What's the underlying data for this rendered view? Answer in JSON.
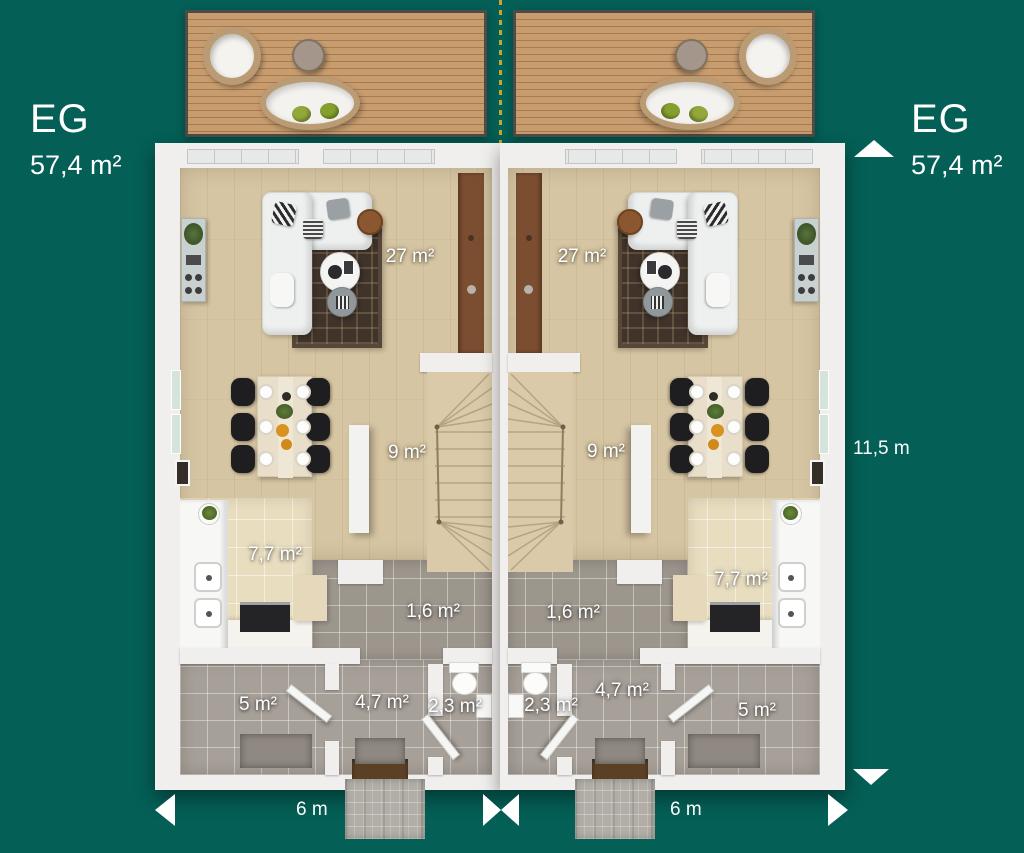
{
  "colors": {
    "background": "#045f56",
    "label": "#ffffff",
    "boundary_line": "#c9a52c"
  },
  "left_badge": {
    "floor": "EG",
    "area": "57,4 m²"
  },
  "right_badge": {
    "floor": "EG",
    "area": "57,4 m²"
  },
  "dimensions": {
    "depth": "11,5 m",
    "width_left_unit": "6 m",
    "width_right_unit": "6 m"
  },
  "unit_left_rooms": {
    "living_room": "27 m²",
    "hallway": "9 m²",
    "kitchen": "7,7 m²",
    "corridor": "1,6 m²",
    "utility_room": "5 m²",
    "entry_hall": "4,7 m²",
    "wc": "2,3 m²"
  },
  "unit_right_rooms": {
    "living_room": "27 m²",
    "hallway": "9 m²",
    "kitchen": "7,7 m²",
    "corridor": "1,6 m²",
    "utility_room": "5 m²",
    "entry_hall": "4,7 m²",
    "wc": "2,3 m²"
  }
}
